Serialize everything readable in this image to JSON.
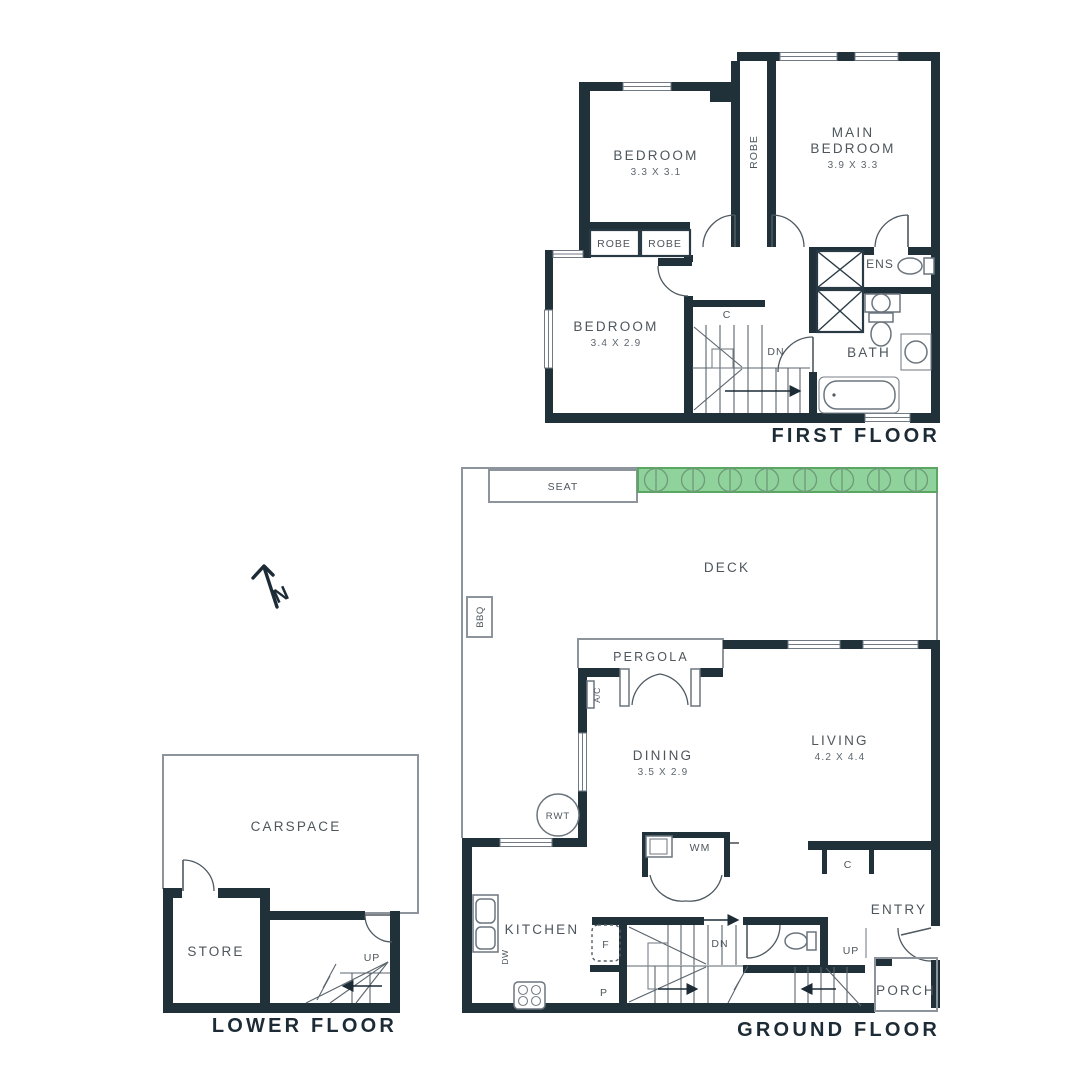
{
  "colors": {
    "wall": "#20313a",
    "hedge_fill": "#90d29b",
    "hedge_stroke": "#5aa662",
    "thin_line": "#8d949c",
    "label_text": "#4d565c",
    "title_text": "#1c2b35"
  },
  "compass": {
    "north_label": "N"
  },
  "first_floor": {
    "title": "FIRST FLOOR",
    "bedroom1": {
      "name": "BEDROOM",
      "dims": "3.3 X 3.1"
    },
    "main_bedroom": {
      "line1": "MAIN",
      "line2": "BEDROOM",
      "dims": "3.9 X 3.3"
    },
    "bedroom3": {
      "name": "BEDROOM",
      "dims": "3.4 X 2.9"
    },
    "robe_corridor": "ROBE",
    "robe_box1": "ROBE",
    "robe_box2": "ROBE",
    "cupboard": "C",
    "stairs_down": "DN",
    "ensuite": "ENS",
    "bathroom": "BATH"
  },
  "ground_floor": {
    "title": "GROUND FLOOR",
    "deck": "DECK",
    "seat": "SEAT",
    "bbq": "BBQ",
    "pergola": "PERGOLA",
    "aircon": "A/C",
    "dining": {
      "name": "DINING",
      "dims": "3.5 X 2.9"
    },
    "living": {
      "name": "LIVING",
      "dims": "4.2 X 4.4"
    },
    "rainwater_tank": "RWT",
    "washing_machine": "WM",
    "cupboard": "C",
    "kitchen": "KITCHEN",
    "dishwasher": "DW",
    "fridge": "F",
    "pantry": "P",
    "stairs_down": "DN",
    "stairs_up": "UP",
    "entry": "ENTRY",
    "porch": "PORCH"
  },
  "lower_floor": {
    "title": "LOWER FLOOR",
    "carspace": "CARSPACE",
    "store": "STORE",
    "stairs_up": "UP"
  }
}
